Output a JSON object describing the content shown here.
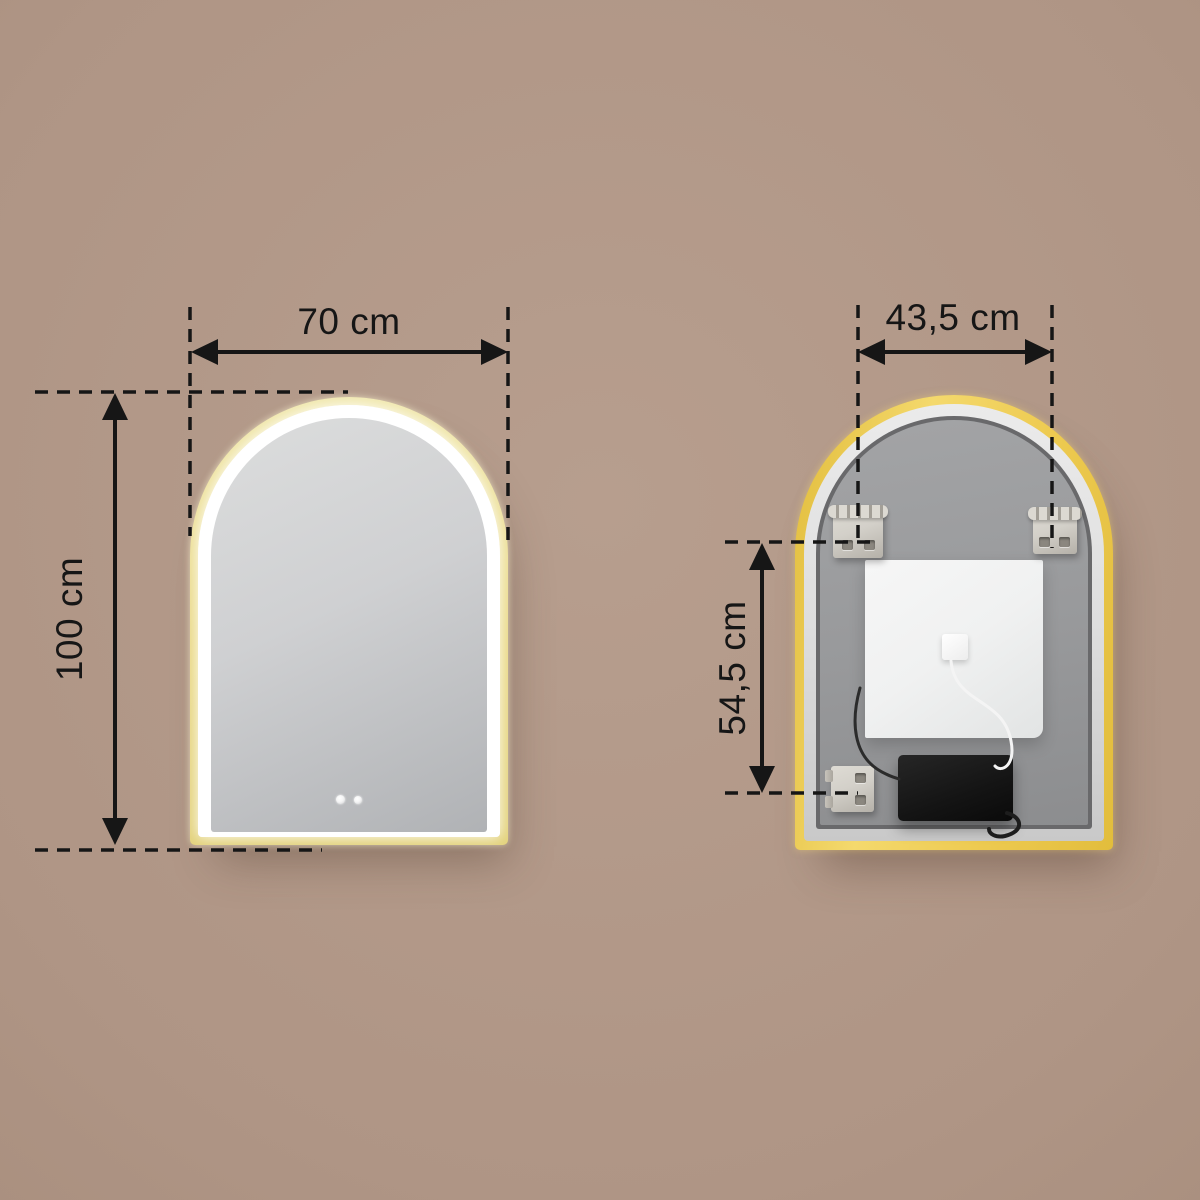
{
  "diagram": {
    "title": "arched-led-mirror-dimension-diagram",
    "front_view": {
      "name": "mirror-front-view",
      "width_dimension": {
        "label": "70 cm"
      },
      "height_dimension": {
        "label": "100 cm"
      },
      "touch_buttons": [
        "touch-sensor-icon",
        "touch-sensor-icon"
      ]
    },
    "back_view": {
      "name": "mirror-back-view",
      "width_dimension": {
        "label": "43,5 cm"
      },
      "height_dimension": {
        "label": "54,5 cm"
      },
      "parts": [
        "mounting-bracket-top-left",
        "mounting-bracket-top-right",
        "mounting-bracket-bottom-left",
        "backing-panel",
        "junction-connector",
        "led-driver-box",
        "power-cable-white",
        "power-cable-black"
      ]
    }
  },
  "colors": {
    "background_center": "#b79e8e",
    "background_edge": "#9a8170",
    "dimension_line": "#161616",
    "frame_gold_front_light": "#f0e7ac",
    "frame_gold_front_dark": "#e3d27c",
    "frame_gold_back_light": "#f4d96d",
    "frame_gold_back_dark": "#e2bd3c",
    "led_white": "#ffffff",
    "glass_light": "#dcdddd",
    "glass_dark": "#b0b2b5",
    "silver_frame_light": "#ebebeb",
    "silver_frame_dark": "#c9c9c9",
    "groove": "#69696b",
    "back_panel_light": "#a3a4a6",
    "back_panel_dark": "#8c8d8f",
    "backing_white": "#f0f1f1",
    "driver_black": "#141414",
    "bracket_metal": "#d3d0c9"
  }
}
